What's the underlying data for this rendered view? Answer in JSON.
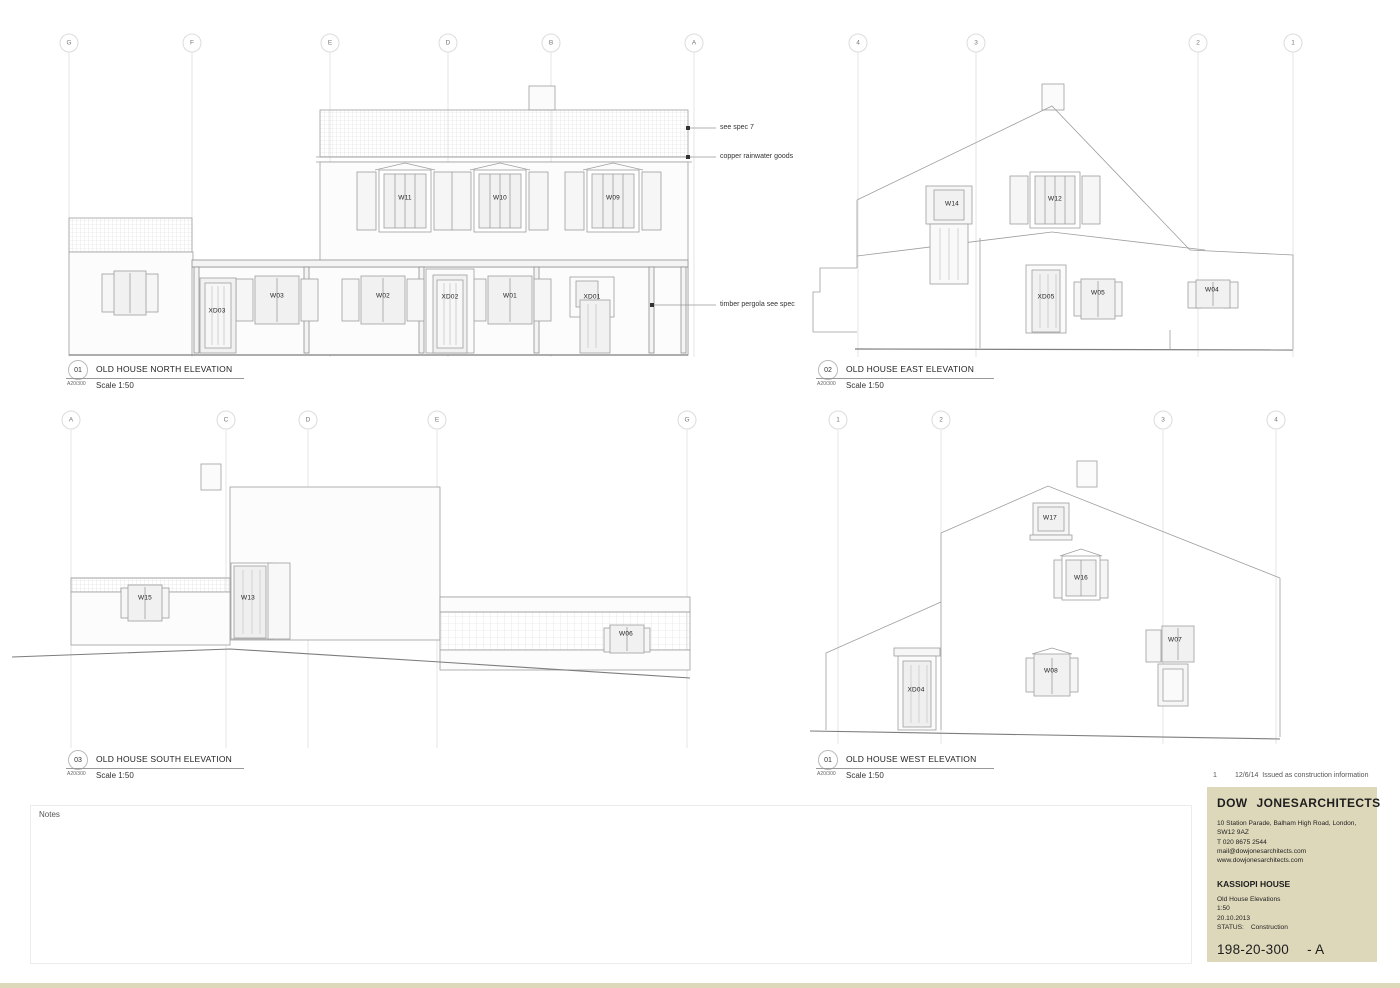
{
  "sheet": {
    "notes_label": "Notes"
  },
  "revision_history": {
    "number": "1",
    "date": "12/6/14",
    "text": "Issued as construction information"
  },
  "title_block": {
    "firm_word1": "DOW",
    "firm_word2": "JONES",
    "firm_word3": "ARCHITECTS",
    "address": "10 Station Parade, Balham High Road, London, SW12 9AZ",
    "phone": "T 020 8675 2544",
    "email": "mail@dowjonesarchitects.com",
    "website": "www.dowjonesarchitects.com",
    "project": "KASSIOPI HOUSE",
    "drawing_title": "Old House Elevations",
    "scale": "1:50",
    "date": "20.10.2013",
    "status_label": "STATUS:",
    "status_value": "Construction",
    "drawing_number": "198-20-300",
    "revision_suffix": "- A"
  },
  "elevations": {
    "north": {
      "number": "01",
      "ref": "A20/300",
      "title": "OLD HOUSE NORTH ELEVATION",
      "scale": "Scale 1:50",
      "grid": [
        "G",
        "F",
        "E",
        "D",
        "B",
        "A"
      ],
      "tags": [
        "W11",
        "W10",
        "W09",
        "XD03",
        "W03",
        "W02",
        "XD02",
        "W01",
        "XD01"
      ],
      "annotations": [
        "see spec 7",
        "copper rainwater goods",
        "timber pergola see spec"
      ]
    },
    "east": {
      "number": "02",
      "ref": "A20/300",
      "title": "OLD HOUSE EAST ELEVATION",
      "scale": "Scale 1:50",
      "grid": [
        "4",
        "3",
        "2",
        "1"
      ],
      "tags": [
        "W14",
        "W12",
        "XD05",
        "W05",
        "W04"
      ]
    },
    "south": {
      "number": "03",
      "ref": "A20/300",
      "title": "OLD HOUSE SOUTH ELEVATION",
      "scale": "Scale 1:50",
      "grid": [
        "A",
        "C",
        "D",
        "E",
        "G"
      ],
      "tags": [
        "W15",
        "W13",
        "W06"
      ]
    },
    "west": {
      "number": "01",
      "ref": "A20/300",
      "title": "OLD HOUSE WEST ELEVATION",
      "scale": "Scale 1:50",
      "grid": [
        "1",
        "2",
        "3",
        "4"
      ],
      "tags": [
        "W17",
        "W16",
        "W07",
        "W08",
        "XD04"
      ]
    }
  }
}
